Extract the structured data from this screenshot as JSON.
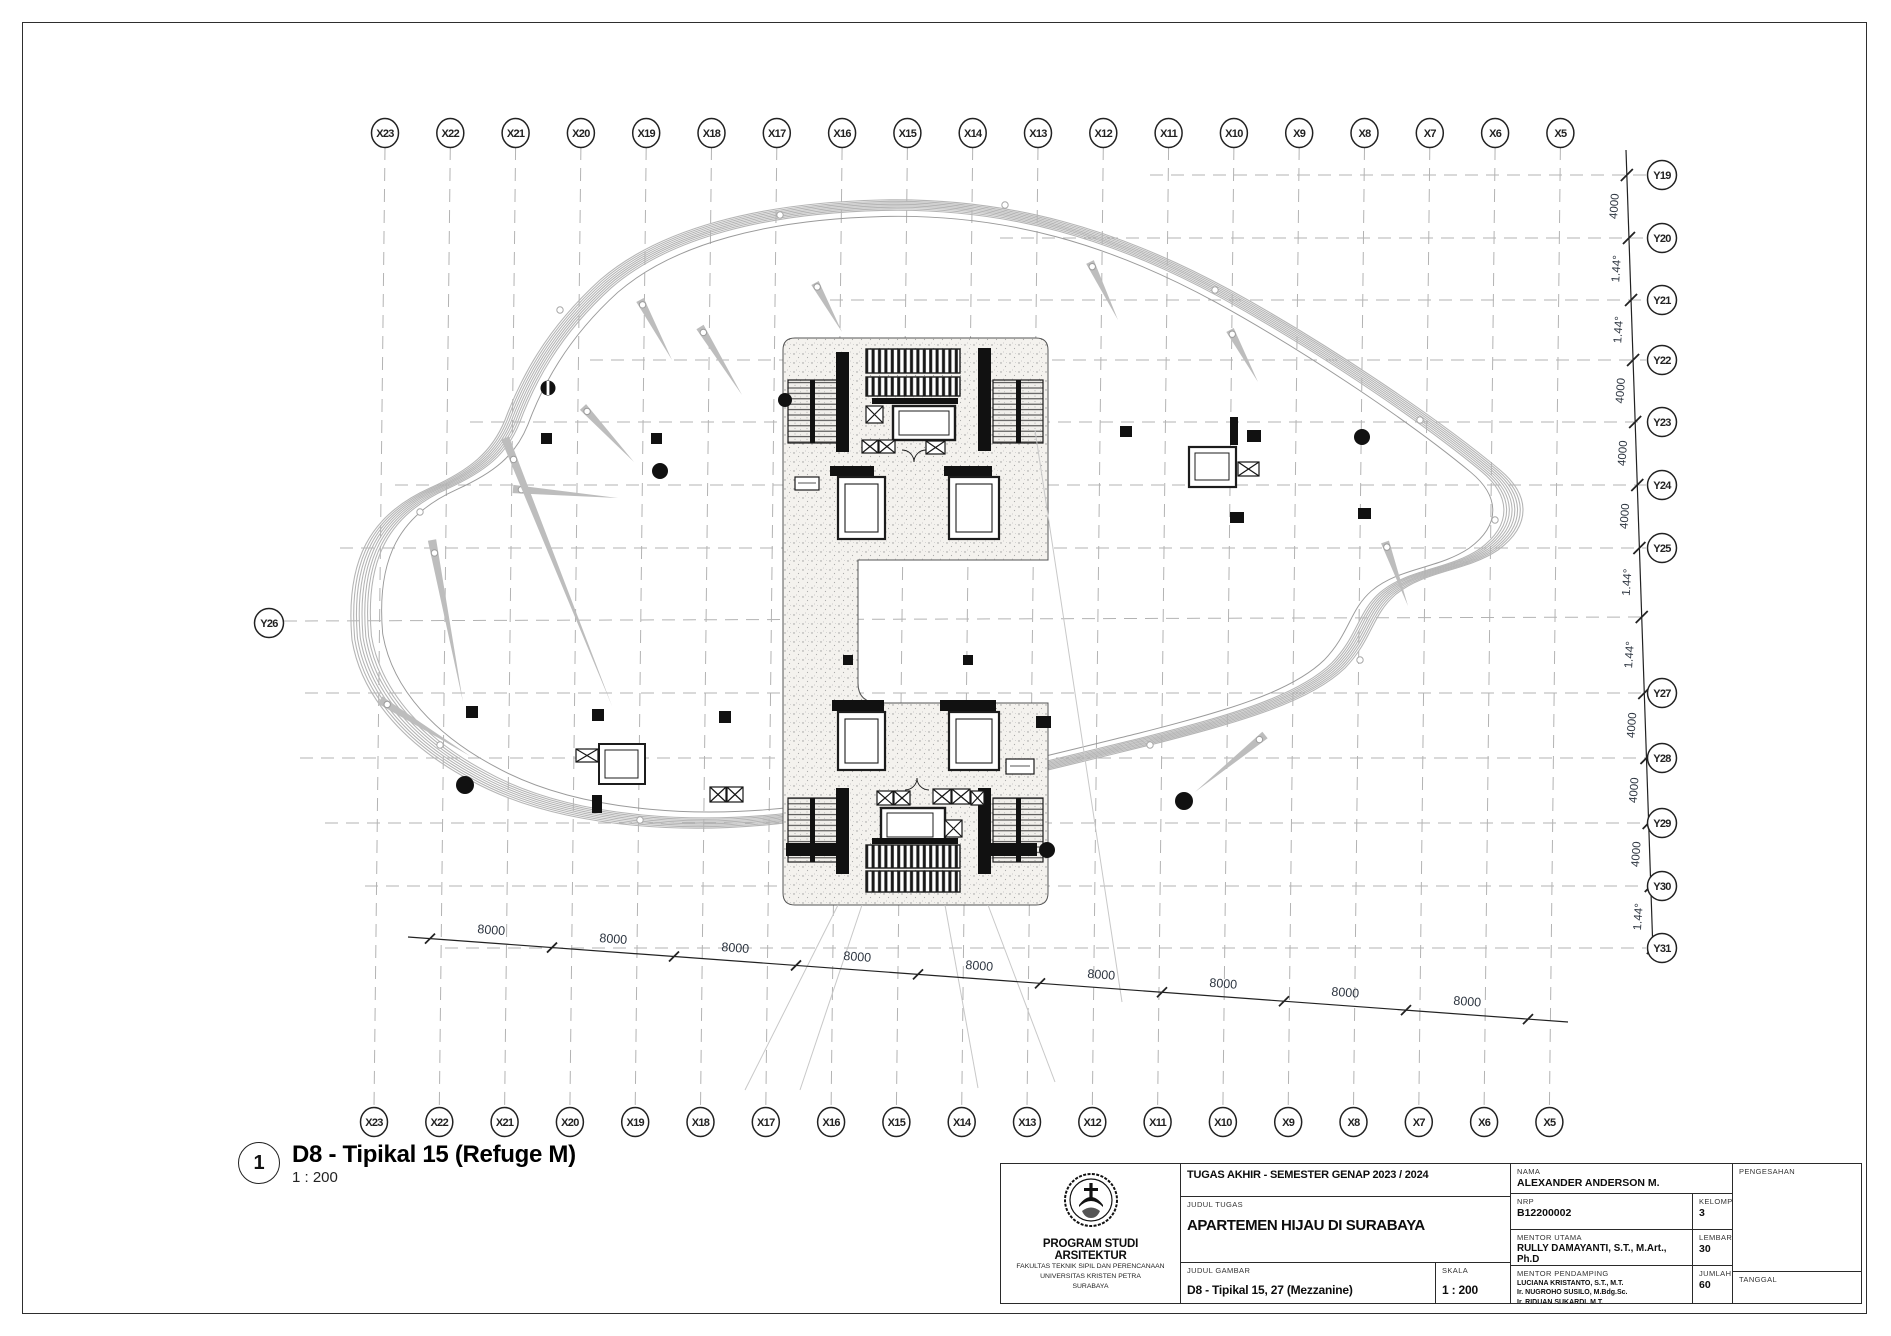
{
  "sheet": {
    "callout_number": "1",
    "drawing_title": "D8 - Tipikal 15 (Refuge M)",
    "drawing_scale": "1 : 200"
  },
  "grid": {
    "x_labels": [
      "X23",
      "X22",
      "X21",
      "X20",
      "X19",
      "X18",
      "X17",
      "X16",
      "X15",
      "X14",
      "X13",
      "X12",
      "X11",
      "X10",
      "X9",
      "X8",
      "X7",
      "X6",
      "X5"
    ],
    "y_labels_right": [
      "Y19",
      "Y20",
      "Y21",
      "Y22",
      "Y23",
      "Y24",
      "Y25",
      "Y27",
      "Y28",
      "Y29",
      "Y30",
      "Y31"
    ],
    "y_label_left": "Y26"
  },
  "dimensions": {
    "right_chain": [
      "4000",
      "1.44°",
      "1.44°",
      "4000",
      "4000",
      "4000",
      "1.44°",
      "1.44°",
      "4000",
      "4000",
      "4000",
      "1.44°"
    ],
    "bottom_chain": [
      "8000",
      "8000",
      "8000",
      "8000",
      "8000",
      "8000",
      "8000",
      "8000",
      "8000"
    ]
  },
  "title_block": {
    "header": "TUGAS AKHIR - SEMESTER GENAP 2023 / 2024",
    "judul_tugas_label": "JUDUL TUGAS",
    "judul_tugas": "APARTEMEN HIJAU DI SURABAYA",
    "judul_gambar_label": "JUDUL GAMBAR",
    "judul_gambar": "D8 - Tipikal 15, 27 (Mezzanine)",
    "skala_label": "SKALA",
    "skala": "1 : 200",
    "nama_label": "NAMA",
    "nama": "ALEXANDER ANDERSON M.",
    "nrp_label": "NRP",
    "nrp": "B12200002",
    "kelompok_label": "KELOMPOK",
    "kelompok": "3",
    "mentor_utama_label": "MENTOR UTAMA",
    "mentor_utama": "RULLY DAMAYANTI, S.T., M.Art., Ph.D",
    "lembar_label": "LEMBAR",
    "lembar": "30",
    "mentor_pendamping_label": "MENTOR PENDAMPING",
    "mentor_pendamping": [
      "LUCIANA KRISTANTO, S.T., M.T.",
      "Ir. NUGROHO SUSILO, M.Bdg.Sc.",
      "Ir. RIDUAN SUKARDI, M.T."
    ],
    "jumlah_label": "JUMLAH",
    "jumlah": "60",
    "pengesahan_label": "PENGESAHAN",
    "tanggal_label": "TANGGAL",
    "program": "PROGRAM STUDI ARSITEKTUR",
    "faculty": "FAKULTAS TEKNIK SIPIL DAN PERENCANAAN",
    "university": "UNIVERSITAS KRISTEN PETRA",
    "city": "SURABAYA"
  }
}
